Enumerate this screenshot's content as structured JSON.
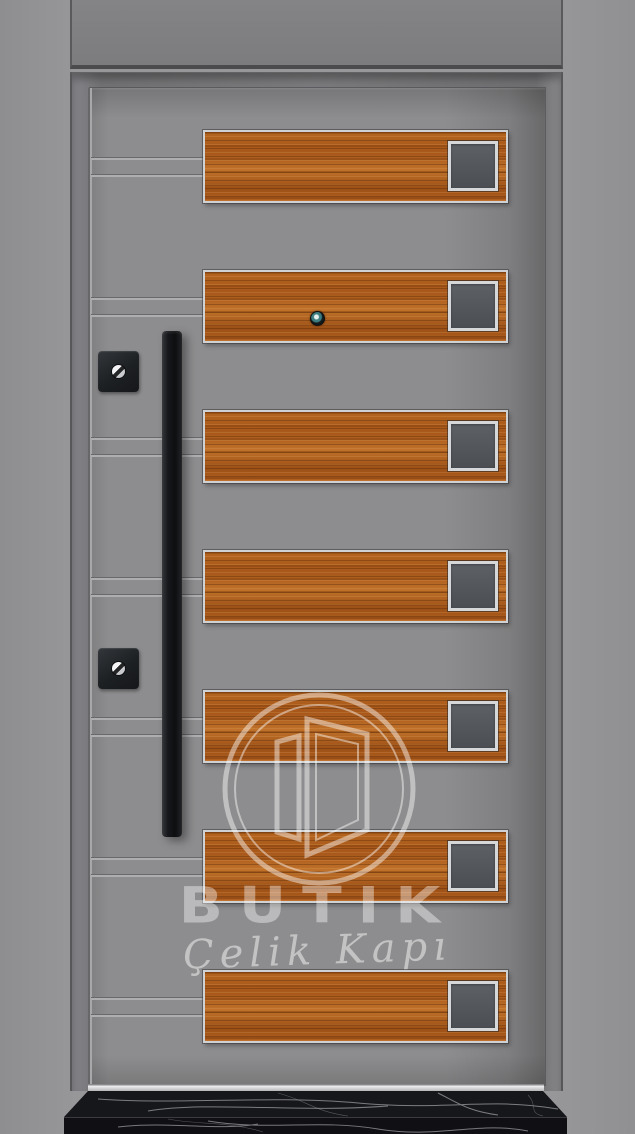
{
  "image": {
    "type": "product-photo",
    "subject": "steel-security-door-with-horizontal-wood-panels",
    "width": 635,
    "height": 1134
  },
  "brand": {
    "name": "BUTIK",
    "tagline": "Çelik Kapı",
    "logo": "open-door-in-double-circle"
  },
  "colors": {
    "wall": "#98989b",
    "transom": "#7f8082",
    "frame_casing": "#747477",
    "door_leaf": "#8d8d8f",
    "wood_base": "#b06020",
    "wood_dark_grain": "#8a4a14",
    "wood_light_grain": "#c87a2e",
    "panel_border_silver": "#d0d1d3",
    "inset_fill": "#53575c",
    "hardware_black": "#17181b",
    "keyhole_silver": "#e9eaec",
    "watermark_white": "rgba(255,255,255,0.45)",
    "sill_strip": "#e8e8ea",
    "marble_black": "#121317",
    "marble_vein": "#cfcfd4"
  },
  "door": {
    "panel_count": 7,
    "panel_geometry": {
      "x": 203,
      "width": 305,
      "height": 73
    },
    "panels": [
      {
        "y": 130
      },
      {
        "y": 270
      },
      {
        "y": 410
      },
      {
        "y": 550
      },
      {
        "y": 690
      },
      {
        "y": 830
      },
      {
        "y": 970
      }
    ],
    "groove_offsets": [
      27,
      44
    ],
    "peephole": {
      "x": 310,
      "y": 311
    },
    "locks": [
      {
        "x": 98,
        "y": 351
      },
      {
        "x": 98,
        "y": 648
      }
    ],
    "handle": {
      "x": 162,
      "y": 331,
      "width": 20,
      "height": 506
    }
  },
  "watermark": {
    "text_primary": "BUTIK",
    "text_secondary": "Çelik Kapı",
    "circle_center_x": 319,
    "circle_center_y": 789,
    "circle_diameter": 196
  }
}
